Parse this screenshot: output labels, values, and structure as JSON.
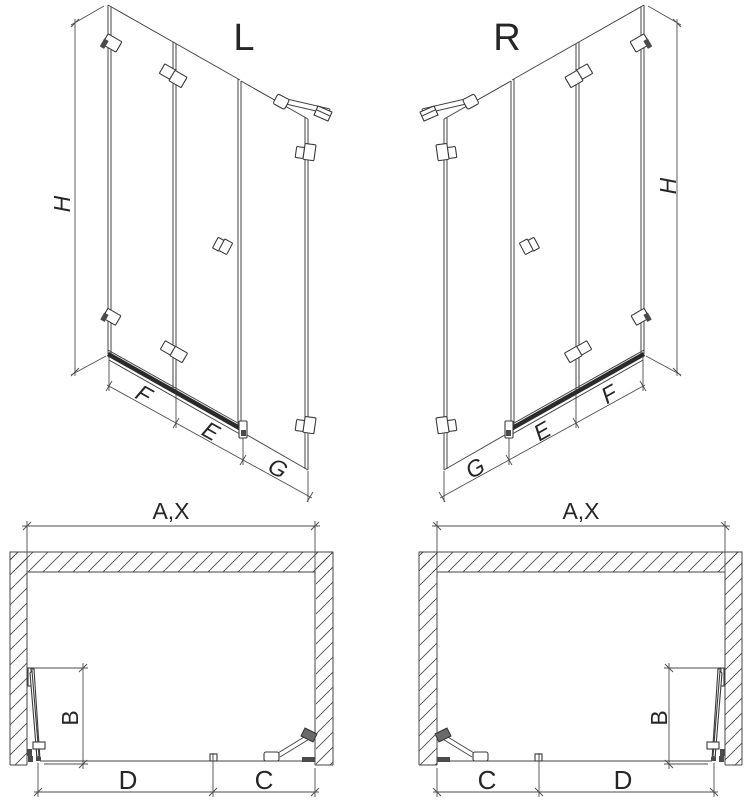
{
  "page": {
    "background": "#ffffff"
  },
  "diagram": {
    "kind": "shower-bath-screen-technical-drawing",
    "colors": {
      "line": "#454545",
      "dimension_line": "#4d4d4d",
      "rail": "#2b2b2b",
      "text": "#262626",
      "hatch": "#4a4a4a",
      "background": "#ffffff"
    },
    "elevation_left": {
      "variant": "L",
      "height_dim": "H",
      "bottom_dims": [
        "F",
        "E",
        "G"
      ]
    },
    "elevation_right": {
      "variant": "R",
      "height_dim": "H",
      "bottom_dims": [
        "G",
        "E",
        "F"
      ]
    },
    "plan_left": {
      "width_dim": "A,X",
      "door_dim": "B",
      "bottom_dims": [
        "D",
        "C"
      ]
    },
    "plan_right": {
      "width_dim": "A,X",
      "door_dim": "B",
      "bottom_dims": [
        "C",
        "D"
      ]
    }
  }
}
